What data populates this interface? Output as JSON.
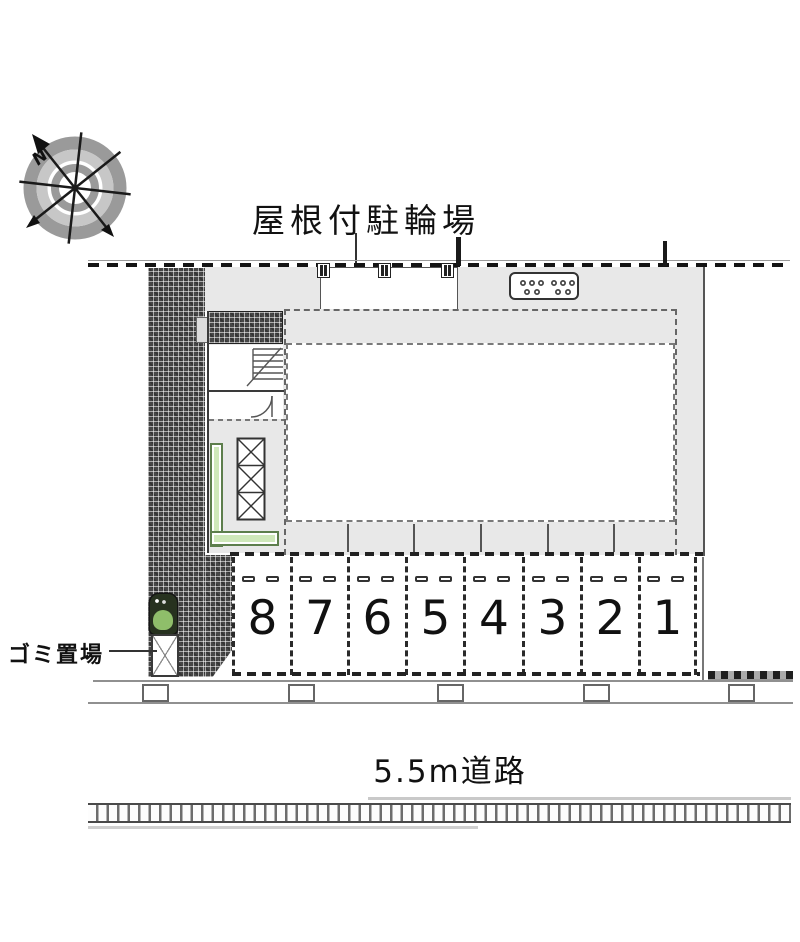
{
  "labels": {
    "bicycle_parking": "屋根付駐輪場",
    "garbage": "ゴミ置場",
    "road": "5.5m道路",
    "compass_n": "N"
  },
  "parking": {
    "spaces": [
      "8",
      "7",
      "6",
      "5",
      "4",
      "3",
      "2",
      "1"
    ]
  },
  "icons": {
    "compass": "compass-rose-icon",
    "tree": "tree-icon",
    "garbage_enclosure": "garbage-x-box-icon",
    "elevator": "elevator-shaft-icon",
    "stairs": "staircase-icon",
    "door": "door-swing-arc-icon",
    "bike_rack": "bicycle-rack-dots-icon",
    "canopy_post": "canopy-post-icon",
    "utility_pole": "utility-pole-icon"
  },
  "colors": {
    "hatch_dark": "#474747",
    "building_gray": "#e8e8e8",
    "planter_green": "#cfe8ba",
    "planter_green_border": "#5d7e4c",
    "line_dark": "#1a1a1a",
    "tree_green": "#8fbe6a"
  }
}
